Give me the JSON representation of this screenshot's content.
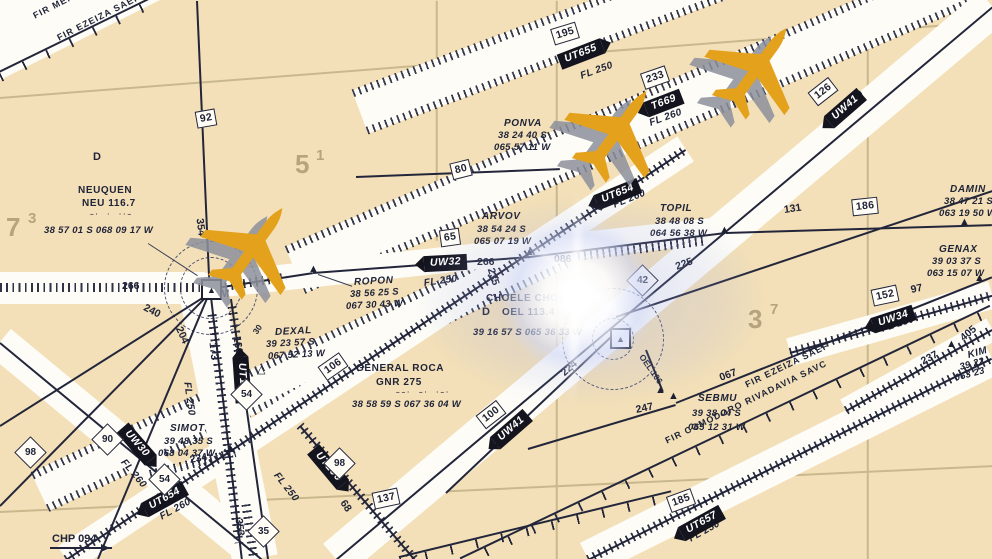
{
  "fir_boundaries": {
    "mendoza": "FIR MENDOZA SA",
    "ezeiza_top": "FIR EZEIZA SAEF",
    "ezeiza_bottom": "FIR EZEIZA SAEF",
    "comodoro": "FIR COMODORO RIVADAVIA SAVC"
  },
  "navaids": {
    "neuquen": {
      "d": "D",
      "name": "NEUQUEN",
      "ident": "NEU 116.7",
      "morse": "–·  ·  ··–",
      "coords": "38 57 01 S 068 09 17 W",
      "m": "M"
    },
    "general_roca": {
      "name": "GENERAL ROCA",
      "ident": "GNR 275",
      "morse": "––·  –·  ·–·",
      "coords": "38 58 59 S 067 36 04 W"
    },
    "choele_choel": {
      "name": "CHOELE CHOEL",
      "dme": "D",
      "ident": "OEL 113.4",
      "coords": "39 16 57 S 065 36 33 W"
    }
  },
  "fixes": {
    "ponva": {
      "name": "PONVA",
      "lat": "38 24 40 S",
      "lon": "065 57 11 W"
    },
    "arvov": {
      "name": "ARVOV",
      "lat": "38 54 24 S",
      "lon": "065 07 19 W"
    },
    "topil": {
      "name": "TOPIL",
      "lat": "38 48 08 S",
      "lon": "064 56 38 W"
    },
    "damin": {
      "name": "DAMIN",
      "lat": "38 47 21 S",
      "lon": "063 19 50 W"
    },
    "genax": {
      "name": "GENAX",
      "lat": "39 03 37 S",
      "lon": "063 15 07 W"
    },
    "ropon": {
      "name": "ROPON",
      "lat": "38 56 25 S",
      "lon": "067 30 43 W"
    },
    "dexal": {
      "name": "DEXAL",
      "lat": "39 23 57 S",
      "lon": "067 52 13 W"
    },
    "sebmu": {
      "name": "SEBMU",
      "lat": "39 38 04 S",
      "lon": "065 12 31 W"
    },
    "simot": {
      "name": "SIMOT",
      "lat": "39 48 35 S",
      "lon": "068 04 37 W"
    },
    "kim": {
      "name": "KIM",
      "lat": "39 22",
      "lon": "063 23"
    }
  },
  "airways": {
    "uw32": "UW32",
    "uw41": "UW41",
    "uw30": "UW30",
    "uw34": "UW34",
    "ut105": "UT105",
    "ut106": "UT106",
    "ut654": "UT654",
    "ut655": "UT655",
    "ut657": "UT657",
    "t669": "T669"
  },
  "flight_levels": {
    "fl250": "FL 250",
    "fl260": "FL 260"
  },
  "distances": {
    "d92": "92",
    "d195": "195",
    "d233": "233",
    "d80": "80",
    "d65": "65",
    "d126": "126",
    "d186": "186",
    "d152": "152",
    "d106": "106",
    "d100": "100",
    "d137": "137",
    "d185": "185",
    "d90": "90",
    "d54": "54",
    "d35": "35",
    "d98": "98",
    "d42": "42",
    "d97": "97",
    "d131": "131",
    "d68": "68"
  },
  "radials": {
    "r354": "354",
    "r266": "266",
    "r240": "240",
    "r204": "204",
    "r173": "173",
    "r160": "160",
    "r086": "086",
    "r235": "235",
    "r225": "225",
    "r224": "224",
    "r247": "247",
    "r067": "067",
    "r237": "237",
    "r234": "234",
    "r353": "353",
    "r30": "30",
    "r405": "405",
    "oel106": "OEL 106"
  },
  "grid_labels": {
    "g5": "5",
    "g5s": "1",
    "g7": "7",
    "g7s": "3",
    "g3": "3",
    "g3s": "7"
  },
  "margin": {
    "chp": "CHP 094"
  },
  "colors": {
    "background": "#f3e0b8",
    "corridor": "#fdfcf7",
    "ink": "#23263a",
    "badge_bg": "#14141e",
    "badge_text": "#ffffff",
    "plane": "#e3a11c",
    "plane_shadow": "#8d919c",
    "grid_line": "#c9b88e",
    "grid_digits": "#b6a47b",
    "flare": "#ffffff",
    "flare_haze": "#96a5e6"
  }
}
